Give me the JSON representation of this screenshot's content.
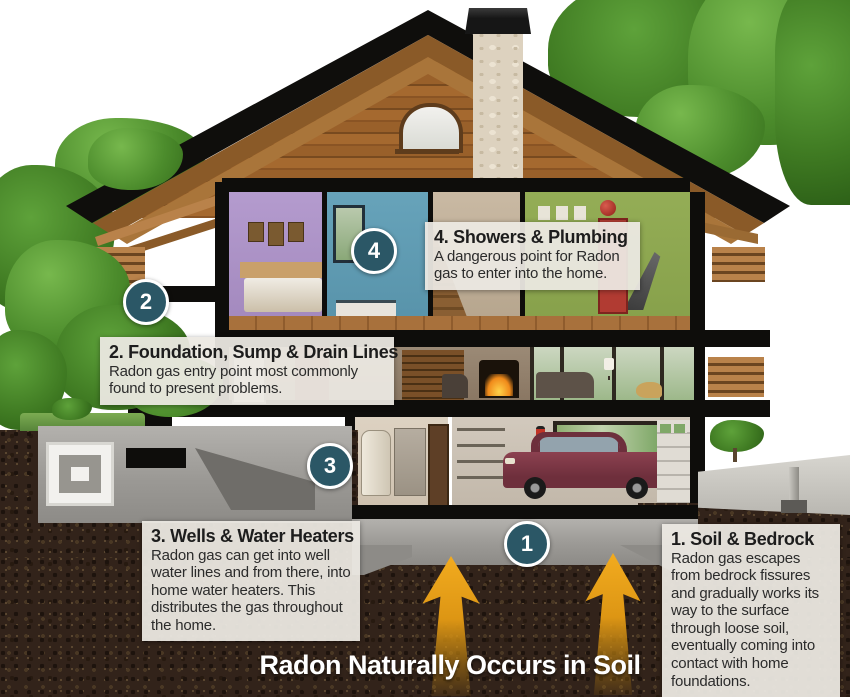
{
  "title": "Radon Naturally Occurs in Soil",
  "callouts": [
    {
      "marker": "1",
      "heading": "1. Soil & Bedrock",
      "body": "Radon gas escapes from bedrock fissures and gradually works its way to the surface through loose soil, eventually coming into contact with home foundations."
    },
    {
      "marker": "2",
      "heading": "2. Foundation, Sump & Drain Lines",
      "body": "Radon gas entry point most commonly found to present problems."
    },
    {
      "marker": "3",
      "heading": "3. Wells & Water Heaters",
      "body": "Radon gas can get into well water lines and from there, into home water heaters. This distributes the gas throughout the home."
    },
    {
      "marker": "4",
      "heading": "4. Showers & Plumbing",
      "body": "A dangerous point for Radon gas to enter into the home."
    }
  ],
  "colors": {
    "marker_teal": "#2b5766",
    "arrow_orange": "#e8a21c",
    "callout_background": "#ece9e2",
    "soil_brown": "#32231a"
  }
}
